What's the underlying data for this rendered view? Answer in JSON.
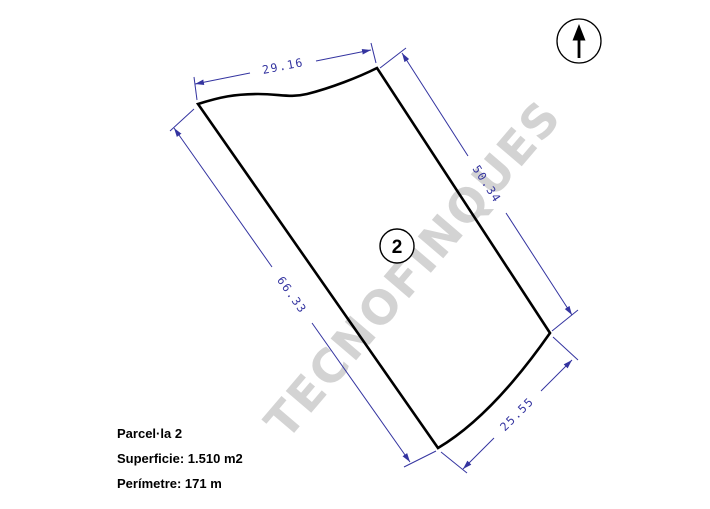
{
  "watermark": {
    "text": "TECNOFINQUES"
  },
  "parcel": {
    "number": "2",
    "dimensions": {
      "top": "29.16",
      "right": "50.34",
      "left": "66.33",
      "bottom": "25.55"
    }
  },
  "north_arrow": {
    "icon": "north-arrow-icon"
  },
  "info": {
    "title": "Parcel·la 2",
    "surface": "Superficie: 1.510 m2",
    "perimeter": "Perímetre: 171 m"
  },
  "colors": {
    "dimension": "#3434a0",
    "boundary": "#000000",
    "watermark": "#d3d3d3",
    "background": "#ffffff",
    "text": "#000000"
  }
}
